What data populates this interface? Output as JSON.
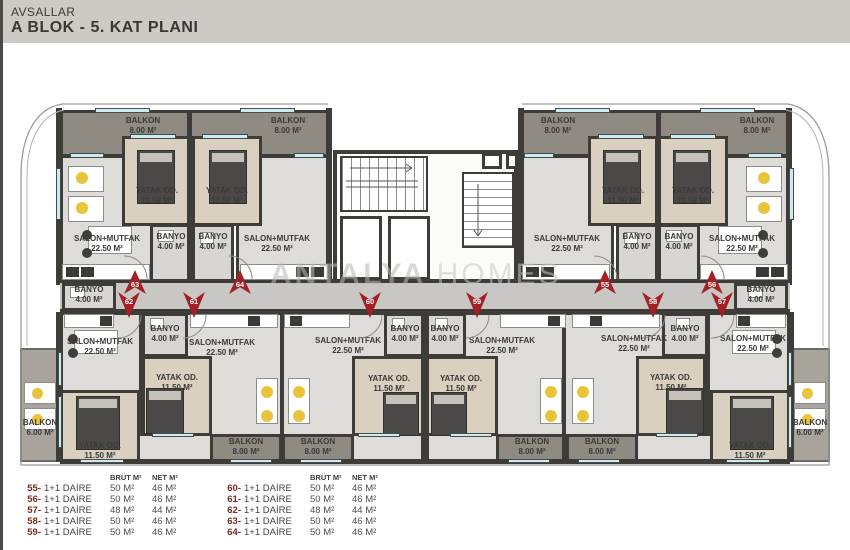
{
  "header": {
    "brand": "AVSALLAR",
    "title": "A BLOK  -  5. KAT PLANI"
  },
  "watermark": {
    "bold": "ANTALYA",
    "light": "HOMES"
  },
  "colors": {
    "marker_red": "#a32126",
    "window_cyan": "#c9ecf4",
    "wall": "#3e3c39"
  },
  "plan": {
    "markers_top": [
      {
        "no": "63",
        "x": 135
      },
      {
        "no": "64",
        "x": 240
      },
      {
        "no": "55",
        "x": 605
      },
      {
        "no": "56",
        "x": 712
      }
    ],
    "markers_bottom": [
      {
        "no": "62",
        "x": 129
      },
      {
        "no": "61",
        "x": 194
      },
      {
        "no": "60",
        "x": 370
      },
      {
        "no": "59",
        "x": 477
      },
      {
        "no": "58",
        "x": 653
      },
      {
        "no": "57",
        "x": 722
      }
    ],
    "labels": [
      {
        "text": "BALKON",
        "area": "8.00 M²",
        "x": 143,
        "y": 116
      },
      {
        "text": "BALKON",
        "area": "8.00 M²",
        "x": 288,
        "y": 116
      },
      {
        "text": "BALKON",
        "area": "8.00 M²",
        "x": 558,
        "y": 116
      },
      {
        "text": "BALKON",
        "area": "8.00 M²",
        "x": 757,
        "y": 116
      },
      {
        "text": "YATAK OD.",
        "area": "11.50 M²",
        "x": 157,
        "y": 186
      },
      {
        "text": "YATAK OD.",
        "area": "11.50 M²",
        "x": 227,
        "y": 186
      },
      {
        "text": "YATAK OD.",
        "area": "11.50 M²",
        "x": 623,
        "y": 186
      },
      {
        "text": "YATAK OD.",
        "area": "11.50 M²",
        "x": 693,
        "y": 186
      },
      {
        "text": "SALON+MUTFAK",
        "area": "22.50 M²",
        "x": 107,
        "y": 234
      },
      {
        "text": "SALON+MUTFAK",
        "area": "22.50 M²",
        "x": 277,
        "y": 234
      },
      {
        "text": "SALON+MUTFAK",
        "area": "22.50 M²",
        "x": 567,
        "y": 234
      },
      {
        "text": "SALON+MUTFAK",
        "area": "22.50 M²",
        "x": 742,
        "y": 234
      },
      {
        "text": "BANYO",
        "area": "4.00 M²",
        "x": 171,
        "y": 232
      },
      {
        "text": "BANYO",
        "area": "4.00 M²",
        "x": 213,
        "y": 232
      },
      {
        "text": "BANYO",
        "area": "4.00 M²",
        "x": 637,
        "y": 232
      },
      {
        "text": "BANYO",
        "area": "4.00 M²",
        "x": 679,
        "y": 232
      },
      {
        "text": "BANYO",
        "area": "4.00 M²",
        "x": 89,
        "y": 285
      },
      {
        "text": "BANYO",
        "area": "4.00 M²",
        "x": 761,
        "y": 285
      },
      {
        "text": "BANYO",
        "area": "4.00 M²",
        "x": 165,
        "y": 324
      },
      {
        "text": "BANYO",
        "area": "4.00 M²",
        "x": 405,
        "y": 324
      },
      {
        "text": "BANYO",
        "area": "4.00 M²",
        "x": 445,
        "y": 324
      },
      {
        "text": "BANYO",
        "area": "4.00 M²",
        "x": 685,
        "y": 324
      },
      {
        "text": "SALON+MUTFAK",
        "area": "22.50 M²",
        "x": 100,
        "y": 337
      },
      {
        "text": "SALON+MUTFAK",
        "area": "22.50 M²",
        "x": 222,
        "y": 338
      },
      {
        "text": "SALON+MUTFAK",
        "area": "22.50 M²",
        "x": 348,
        "y": 336
      },
      {
        "text": "SALON+MUTFAK",
        "area": "22.50 M²",
        "x": 502,
        "y": 336
      },
      {
        "text": "SALON+MUTFAK",
        "area": "22.50 M²",
        "x": 634,
        "y": 334
      },
      {
        "text": "SALON+MUTFAK",
        "area": "22.50 M²",
        "x": 753,
        "y": 334
      },
      {
        "text": "YATAK OD.",
        "area": "11.50 M²",
        "x": 100,
        "y": 441
      },
      {
        "text": "YATAK OD.",
        "area": "11.50 M²",
        "x": 177,
        "y": 373
      },
      {
        "text": "YATAK OD.",
        "area": "11.50 M²",
        "x": 389,
        "y": 374
      },
      {
        "text": "YATAK OD.",
        "area": "11.50 M²",
        "x": 461,
        "y": 374
      },
      {
        "text": "YATAK OD.",
        "area": "11.50 M²",
        "x": 671,
        "y": 373
      },
      {
        "text": "YATAK OD.",
        "area": "11.50 M²",
        "x": 750,
        "y": 441
      },
      {
        "text": "BALKON",
        "area": "8.00 M²",
        "x": 246,
        "y": 437
      },
      {
        "text": "BALKON",
        "area": "8.00 M²",
        "x": 318,
        "y": 437
      },
      {
        "text": "BALKON",
        "area": "8.00 M²",
        "x": 532,
        "y": 437
      },
      {
        "text": "BALKON",
        "area": "8.00 M²",
        "x": 602,
        "y": 437
      },
      {
        "text": "BALKON",
        "area": "6.00 M²",
        "x": 40,
        "y": 418
      },
      {
        "text": "BALKON",
        "area": "6.00 M²",
        "x": 810,
        "y": 418
      }
    ]
  },
  "legend": {
    "headers": {
      "brut": "BRÜT M²",
      "net": "NET M²"
    },
    "left": [
      {
        "no": "55-",
        "type": "1+1 DAİRE",
        "brut": "50 M²",
        "net": "46 M²"
      },
      {
        "no": "56-",
        "type": "1+1 DAİRE",
        "brut": "50 M²",
        "net": "46 M²"
      },
      {
        "no": "57-",
        "type": "1+1 DAİRE",
        "brut": "48 M²",
        "net": "44 M²"
      },
      {
        "no": "58-",
        "type": "1+1 DAİRE",
        "brut": "50 M²",
        "net": "46 M²"
      },
      {
        "no": "59-",
        "type": "1+1 DAİRE",
        "brut": "50 M²",
        "net": "46 M²"
      }
    ],
    "right": [
      {
        "no": "60-",
        "type": "1+1 DAİRE",
        "brut": "50 M²",
        "net": "46 M²"
      },
      {
        "no": "61-",
        "type": "1+1 DAİRE",
        "brut": "50 M²",
        "net": "46 M²"
      },
      {
        "no": "62-",
        "type": "1+1 DAİRE",
        "brut": "48 M²",
        "net": "44 M²"
      },
      {
        "no": "63-",
        "type": "1+1 DAİRE",
        "brut": "50 M²",
        "net": "46 M²"
      },
      {
        "no": "64-",
        "type": "1+1 DAİRE",
        "brut": "50 M²",
        "net": "46 M²"
      }
    ]
  }
}
